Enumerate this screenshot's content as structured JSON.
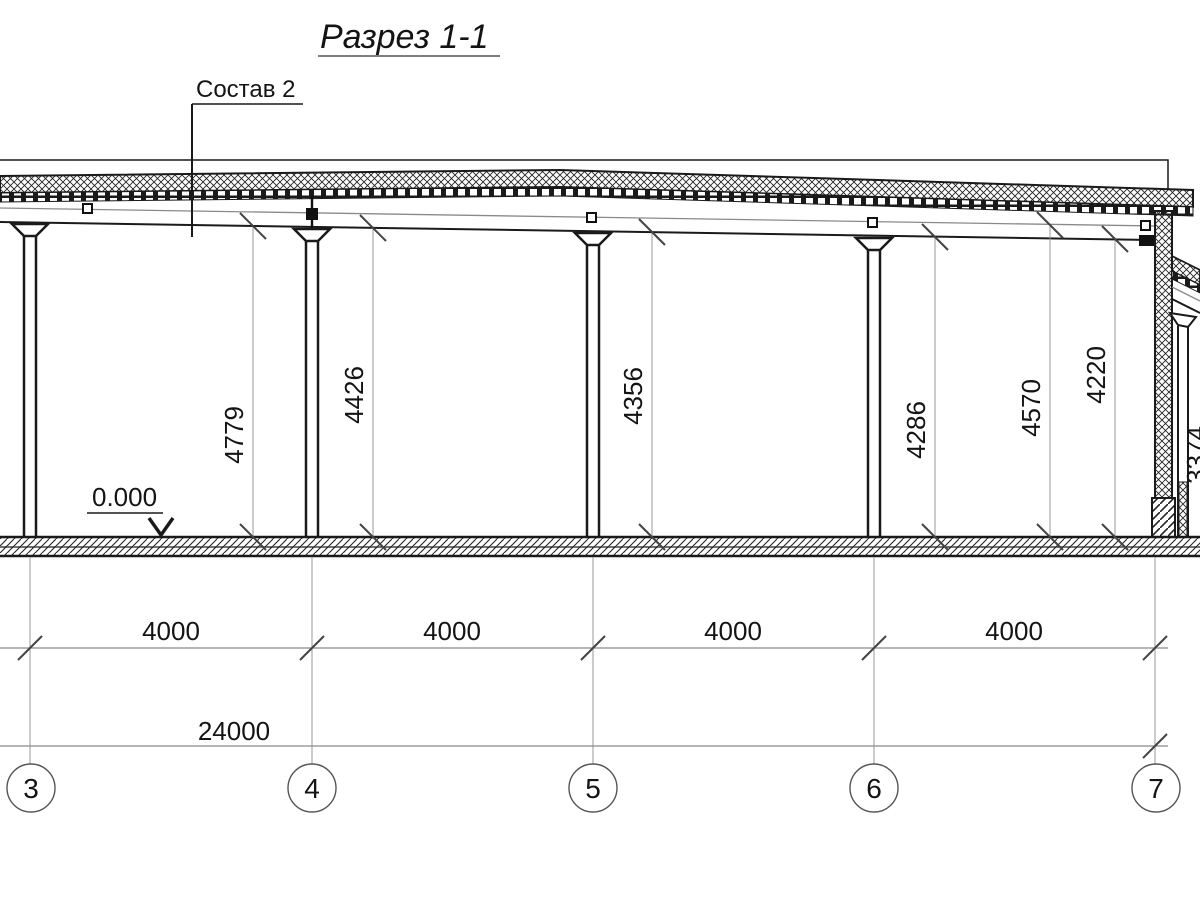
{
  "drawing": {
    "title": "Разрез 1-1",
    "callout_label": "Состав 2",
    "level_mark": "0.000",
    "vertical_dims": [
      "4779",
      "4426",
      "4356",
      "4286",
      "4570",
      "4220",
      "3374"
    ],
    "bay_dims": [
      "4000",
      "4000",
      "4000",
      "4000"
    ],
    "total_dim": "24000",
    "grid_bubbles": [
      "3",
      "4",
      "5",
      "6",
      "7"
    ],
    "colors": {
      "line": "#1a1a1a",
      "dim_line": "#8a8a8a",
      "grid_line": "#999999",
      "tick": "#444444"
    }
  }
}
